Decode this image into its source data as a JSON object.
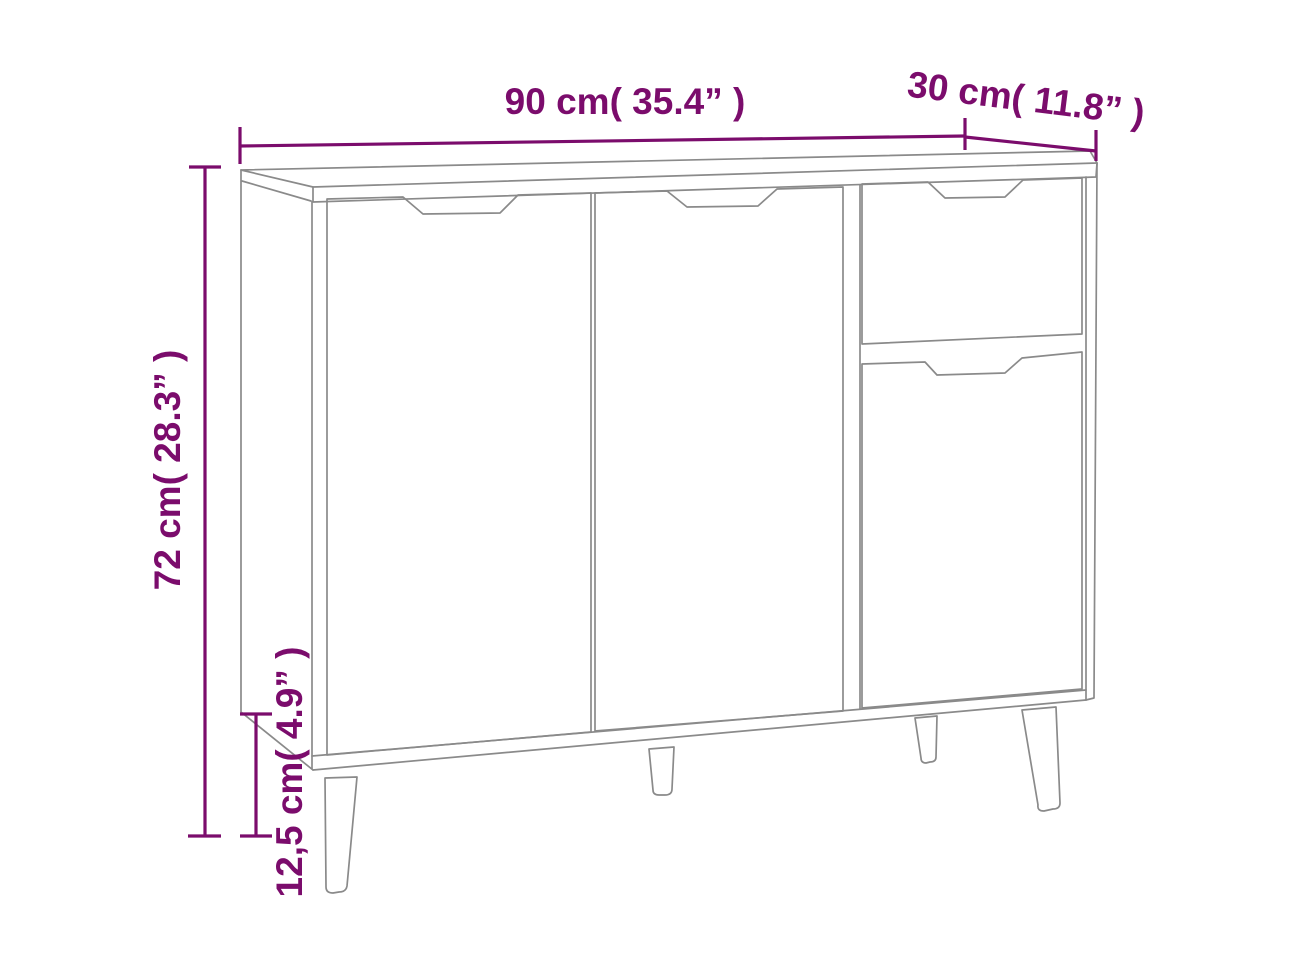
{
  "diagram": {
    "kind": "furniture-dimension-diagram",
    "product": "sideboard with 3 doors and 1 drawer on tapered legs",
    "labels": {
      "width": "90 cm( 35.4” )",
      "depth": "30 cm( 11.8” )",
      "height": "72 cm( 28.3” )",
      "leg_height": "12,5 cm( 4.9” )"
    },
    "values": {
      "width_cm": "90",
      "width_in": "35.4",
      "depth_cm": "30",
      "depth_in": "11.8",
      "height_cm": "72",
      "height_in": "28.3",
      "leg_height_cm": "12,5",
      "leg_height_in": "4.9"
    },
    "colors": {
      "annotation": "#7b0c6c",
      "outline": "#8a8a8a",
      "background": "#ffffff"
    }
  }
}
